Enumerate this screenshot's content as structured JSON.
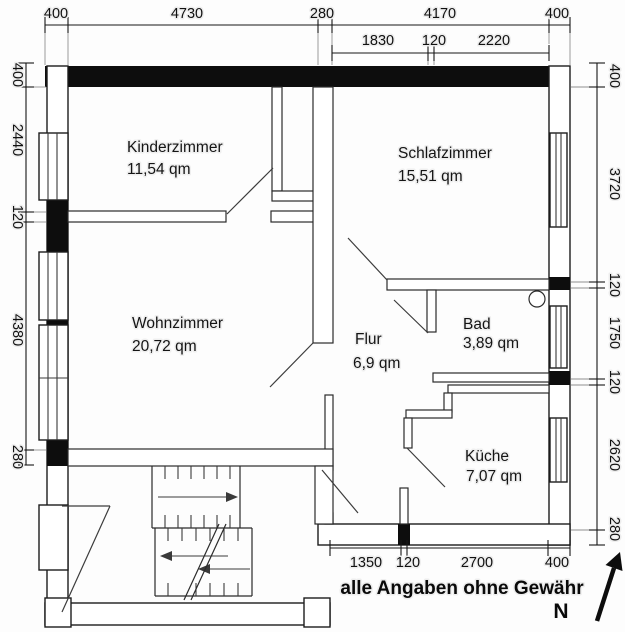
{
  "dims": {
    "top1": [
      "400",
      "4730",
      "280",
      "4170",
      "400"
    ],
    "top2": [
      "1830",
      "120",
      "2220"
    ],
    "left": [
      "400",
      "2440",
      "120",
      "4380",
      "280"
    ],
    "right": [
      "400",
      "3720",
      "120",
      "1750",
      "120",
      "2620",
      "280"
    ],
    "bottom": [
      "1350",
      "120",
      "2700",
      "400"
    ]
  },
  "rooms": {
    "kinderzimmer": {
      "name": "Kinderzimmer",
      "area": "11,54 qm"
    },
    "schlafzimmer": {
      "name": "Schlafzimmer",
      "area": "15,51 qm"
    },
    "wohnzimmer": {
      "name": "Wohnzimmer",
      "area": "20,72 qm"
    },
    "flur": {
      "name": "Flur",
      "area": "6,9 qm"
    },
    "bad": {
      "name": "Bad",
      "area": "3,89 qm"
    },
    "kueche": {
      "name": "Küche",
      "area": "7,07 qm"
    }
  },
  "footer": {
    "disclaimer": "alle Angaben ohne Gewähr",
    "north": "N"
  },
  "icons": {
    "north_arrow": "north-arrow",
    "sink": "bathroom-sink"
  },
  "colors": {
    "line": "#1a1a1a",
    "wall": "#0d0d0d",
    "background": "#fdfdfd"
  }
}
